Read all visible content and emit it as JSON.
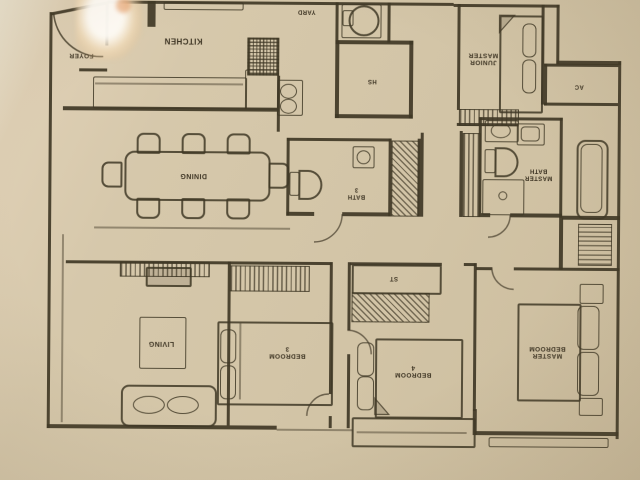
{
  "palette": {
    "paper": "#d6c8ab",
    "paper_light": "#ece4d0",
    "ink": "#403826",
    "label_text": "#3e3524"
  },
  "rooms": {
    "foyer": {
      "label": "FOYER"
    },
    "kitchen": {
      "label": "KITCHEN"
    },
    "yard": {
      "label": "YARD"
    },
    "household_shelter": {
      "label": "HS"
    },
    "junior_master": {
      "label": "JUNIOR MASTER",
      "line1": "JUNIOR",
      "line2": "MASTER"
    },
    "ac_ledge": {
      "label": "AC"
    },
    "master_bath": {
      "label": "MASTER BATH",
      "line1": "MASTER",
      "line2": "BATH"
    },
    "bath_3": {
      "label": "BATH 3",
      "line1": "BATH",
      "line2": "3"
    },
    "dining": {
      "label": "DINING"
    },
    "store": {
      "label": "ST"
    },
    "living": {
      "label": "LIVING"
    },
    "bedroom_3": {
      "label": "BEDROOM 3",
      "line1": "BEDROOM",
      "line2": "3"
    },
    "bedroom_4": {
      "label": "BEDROOM 4",
      "line1": "BEDROOM",
      "line2": "4"
    },
    "master_bedroom": {
      "label": "MASTER BEDROOM",
      "line1": "MASTER",
      "line2": "BEDROOM"
    }
  },
  "icons": {
    "entrance_door_arc": "quarter-circle arc",
    "dining_table": "rounded rectangle with 8 chairs",
    "stove": "cross-hatched square",
    "kitchen_sink": "double circles in box",
    "washer_basin": "circle in square",
    "toilet": "tank plus bowl",
    "shower": "square with drain circle",
    "bathtub": "double rounded rectangle",
    "sofa": "rounded rectangle with two cushions",
    "tv_console": "hatched strip with rectangle",
    "rug": "outlined square",
    "bed": "mattress rectangle with pillows",
    "wardrobe": "hatched strip",
    "nightstand": "small square"
  }
}
